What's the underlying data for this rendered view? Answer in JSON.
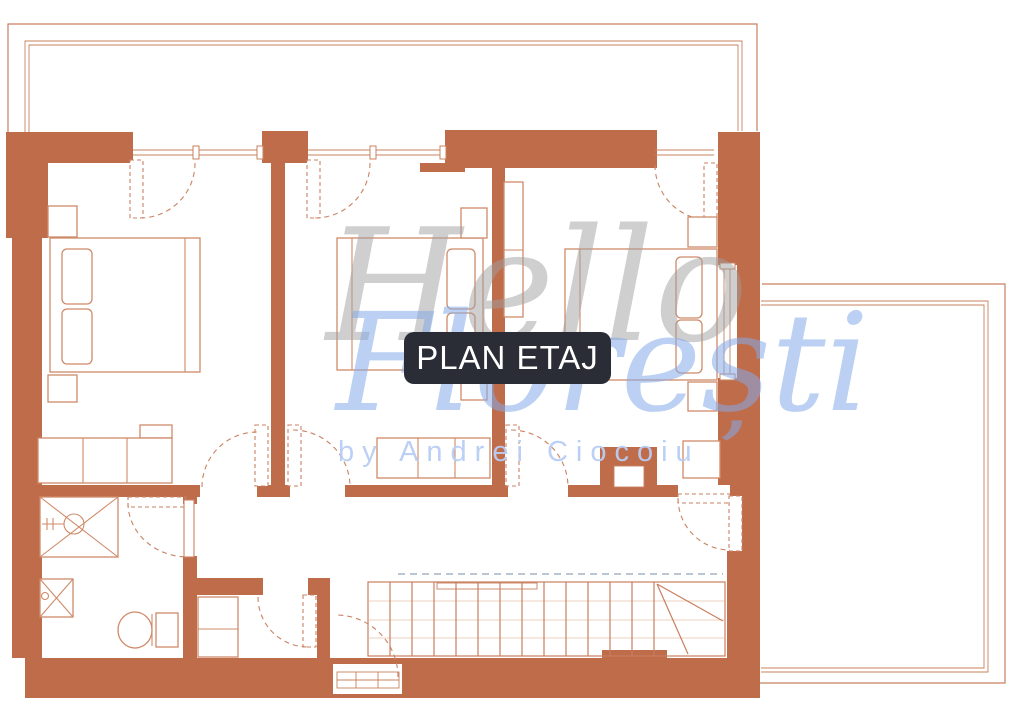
{
  "badge": {
    "label": "PLAN ETAJ"
  },
  "watermark": {
    "title": "Hello",
    "subtitle": "Florești",
    "byline": "by Andrei Ciocoiu"
  },
  "colors": {
    "wall": "#bf6c4b",
    "line": "#c8805f",
    "furniture": "#cf8a69",
    "door": "#cb8263",
    "stair": "#c87e5e",
    "plank": "#e6c0aa",
    "guide": "#a4b4c6",
    "badge_bg": "#2a2d35",
    "badge_text": "#ffffff",
    "watermark_gray": "#a0a0a0",
    "watermark_blue": "#85abe8",
    "byline_blue": "#b9cdf4",
    "paper": "#ffffff"
  }
}
